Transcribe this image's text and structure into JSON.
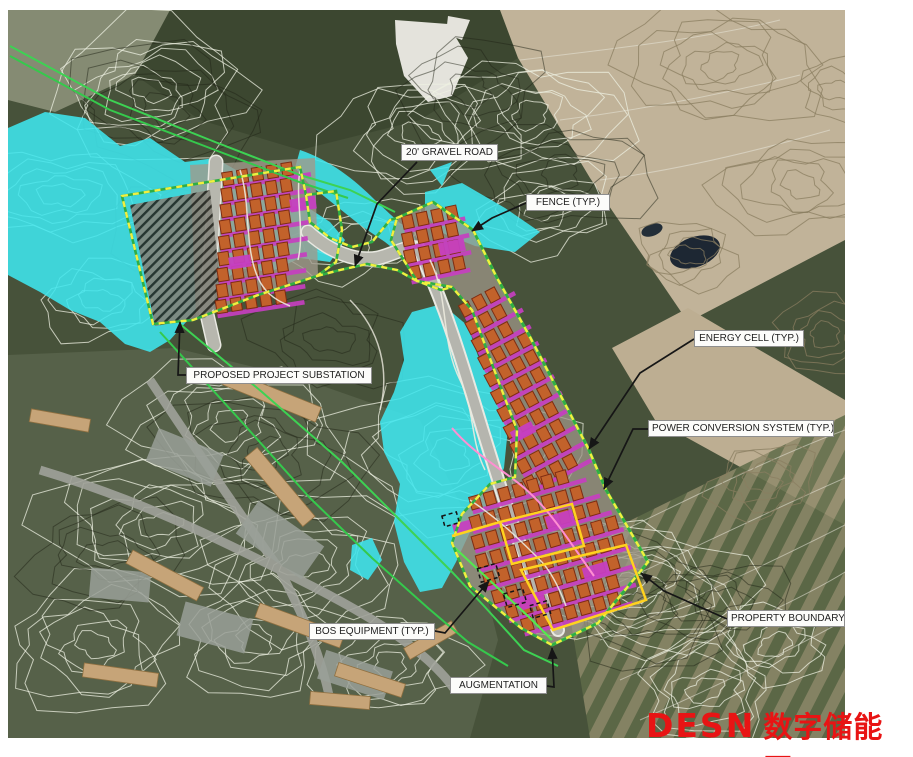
{
  "canvas": {
    "width": 913,
    "height": 757,
    "map_rect": [
      8,
      10,
      837,
      728
    ]
  },
  "watermark": {
    "brand": "DESN",
    "cjk": "数字储能网",
    "color": "#e81414"
  },
  "colors": {
    "wetland_cyan": "#3fe6ee",
    "fence_yellow_dashed": "#f2ef3f",
    "boundary_green": "#3dd253",
    "energy_cell_orange": "#c2622b",
    "pcs_magenta": "#c63fc0",
    "inner_boundary_yellow": "#ffd21f",
    "leader_black": "#161616"
  },
  "labels": [
    {
      "id": "gravel-road",
      "text": "20' GRAVEL ROAD",
      "x": 401,
      "y": 144,
      "w": 97,
      "leader": [
        [
          417,
          162
        ],
        [
          377,
          204
        ],
        [
          355,
          266
        ]
      ]
    },
    {
      "id": "fence",
      "text": "FENCE (TYP.)",
      "x": 526,
      "y": 194,
      "w": 84,
      "leader": [
        [
          526,
          203
        ],
        [
          492,
          218
        ],
        [
          472,
          231
        ]
      ]
    },
    {
      "id": "energy-cell",
      "text": "ENERGY CELL (TYP.)",
      "x": 694,
      "y": 330,
      "w": 110,
      "leader": [
        [
          694,
          339
        ],
        [
          640,
          373
        ],
        [
          589,
          449
        ]
      ]
    },
    {
      "id": "power-conversion",
      "text": "POWER CONVERSION SYSTEM (TYP.)",
      "x": 648,
      "y": 420,
      "w": 186,
      "leader": [
        [
          648,
          429
        ],
        [
          633,
          429
        ],
        [
          604,
          489
        ]
      ]
    },
    {
      "id": "property-boundary",
      "text": "PROPERTY BOUNDARY",
      "x": 727,
      "y": 610,
      "w": 118,
      "leader": [
        [
          727,
          619
        ],
        [
          664,
          591
        ],
        [
          641,
          573
        ]
      ]
    },
    {
      "id": "augmentation",
      "text": "AUGMENTATION",
      "x": 450,
      "y": 677,
      "w": 97,
      "leader": [
        [
          547,
          686
        ],
        [
          554,
          687
        ],
        [
          552,
          648
        ]
      ]
    },
    {
      "id": "bos-equipment",
      "text": "BOS EQUIPMENT (TYP.)",
      "x": 309,
      "y": 623,
      "w": 126,
      "leader": [
        [
          435,
          631
        ],
        [
          445,
          633
        ],
        [
          489,
          581
        ]
      ]
    },
    {
      "id": "substation",
      "text": "PROPOSED PROJECT SUBSTATION",
      "x": 186,
      "y": 367,
      "w": 186,
      "leader": [
        [
          186,
          375
        ],
        [
          178,
          375
        ],
        [
          180,
          322
        ]
      ]
    }
  ]
}
